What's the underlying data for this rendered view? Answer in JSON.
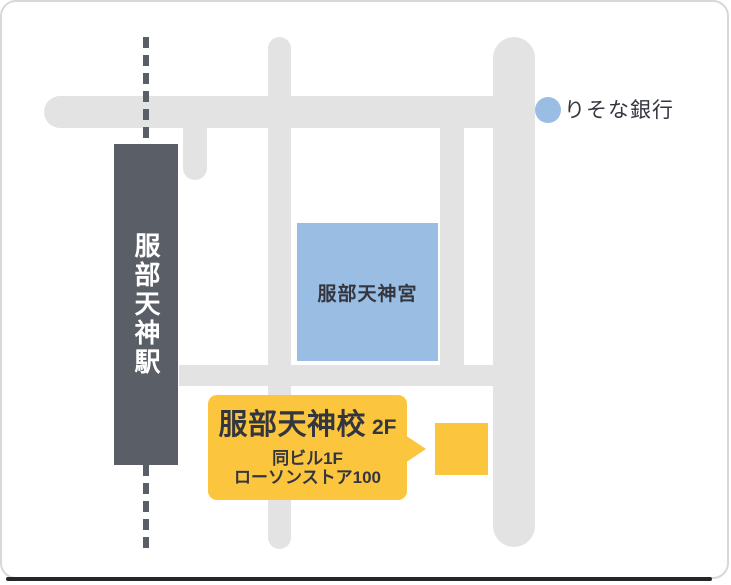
{
  "colors": {
    "station_fill": "#5A5F67",
    "road_fill": "#E3E3E3",
    "landmark_blue": "#9ABEE3",
    "accent_yellow": "#FCC53E",
    "dark_text": "#33363F",
    "white_text": "#FFFFFF",
    "card_border": "#D8D8D8",
    "bottom_bar": "#26262A"
  },
  "station": {
    "name": "服部天神駅"
  },
  "shrine": {
    "name": "服部天神宮"
  },
  "bank": {
    "name": "りそな銀行"
  },
  "school_callout": {
    "title": "服部天神校",
    "floor_suffix": "2F",
    "note_line1": "同ビル1F",
    "note_line2": "ローソンストア100"
  }
}
